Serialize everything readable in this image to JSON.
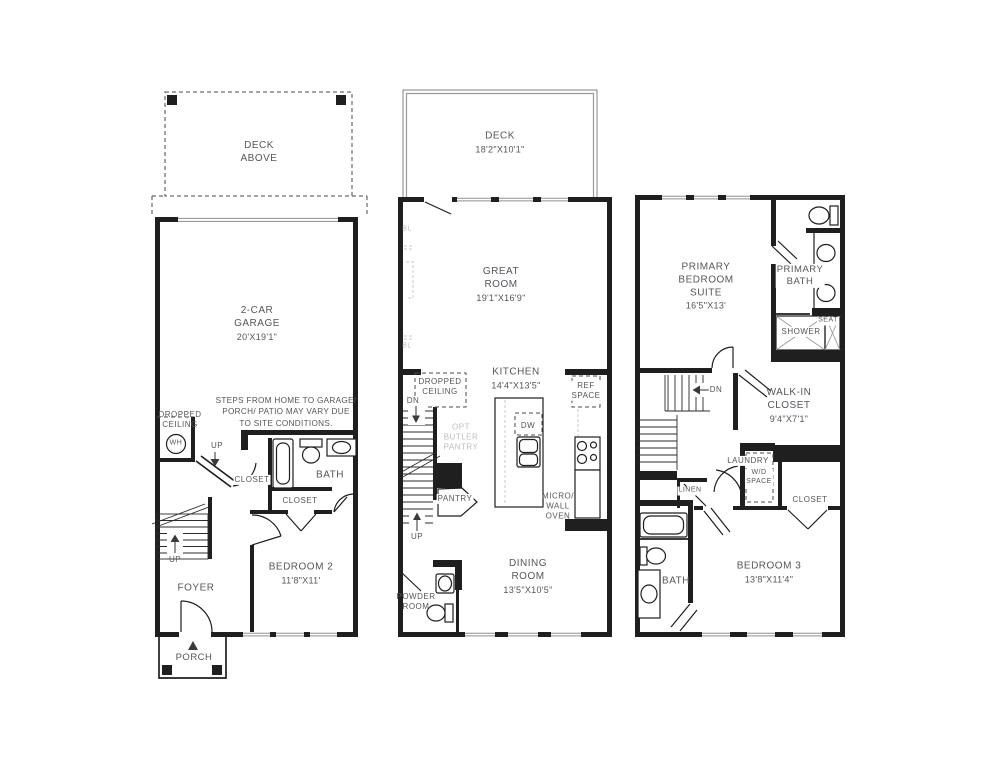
{
  "canvas": {
    "width": 994,
    "height": 768,
    "background": "#ffffff",
    "line_color": "#1f1f1f",
    "text_color": "#55565a",
    "muted_color": "#bdbdbd"
  },
  "floor1": {
    "deck_above": "DECK\nABOVE",
    "garage": {
      "name": "2-CAR\nGARAGE",
      "dims": "20'X19'1\""
    },
    "site_note": "STEPS FROM HOME TO GARAGE/\nPORCH/ PATIO MAY VARY DUE\nTO SITE CONDITIONS.",
    "dropped_ceiling": "DROPPED\nCEILING",
    "water_heater": "WH",
    "up_garage": "UP",
    "up_stairs": "UP",
    "closet_hall": "CLOSET",
    "bath": "BATH",
    "closet_bedroom": "CLOSET",
    "bedroom2": {
      "name": "BEDROOM 2",
      "dims": "11'8\"X11'"
    },
    "foyer": "FOYER",
    "porch": "PORCH"
  },
  "floor2": {
    "deck": {
      "name": "DECK",
      "dims": "18'2\"X10'1\""
    },
    "great_room": {
      "name": "GREAT\nROOM",
      "dims": "19'1\"X16'9\""
    },
    "bl_upper": "BL",
    "bl_lower": "BL",
    "kitchen": {
      "name": "KITCHEN",
      "dims": "14'4\"X13'5\""
    },
    "dropped_ceiling": "DROPPED\nCEILING",
    "dn": "DN",
    "up": "UP",
    "opt_butler_pantry": "OPT\nBUTLER\nPANTRY",
    "pantry": "PANTRY",
    "dishwasher": "DW",
    "ref_space": "REF\nSPACE",
    "micro_wall_oven": "MICRO/\nWALL\nOVEN",
    "dining_room": {
      "name": "DINING\nROOM",
      "dims": "13'5\"X10'5\""
    },
    "powder_room": "POWDER\nROOM"
  },
  "floor3": {
    "primary_suite": {
      "name": "PRIMARY\nBEDROOM\nSUITE",
      "dims": "16'5\"X13'"
    },
    "primary_bath": "PRIMARY\nBATH",
    "shower": "SHOWER",
    "seat": "SEAT",
    "dn": "DN",
    "walk_in_closet": {
      "name": "WALK-IN\nCLOSET",
      "dims": "9'4\"X7'1\""
    },
    "laundry": "LAUNDRY",
    "wd_space": "W/D\nSPACE",
    "linen": "LINEN",
    "closet": "CLOSET",
    "bath": "BATH",
    "bedroom3": {
      "name": "BEDROOM 3",
      "dims": "13'8\"X11'4\""
    }
  }
}
